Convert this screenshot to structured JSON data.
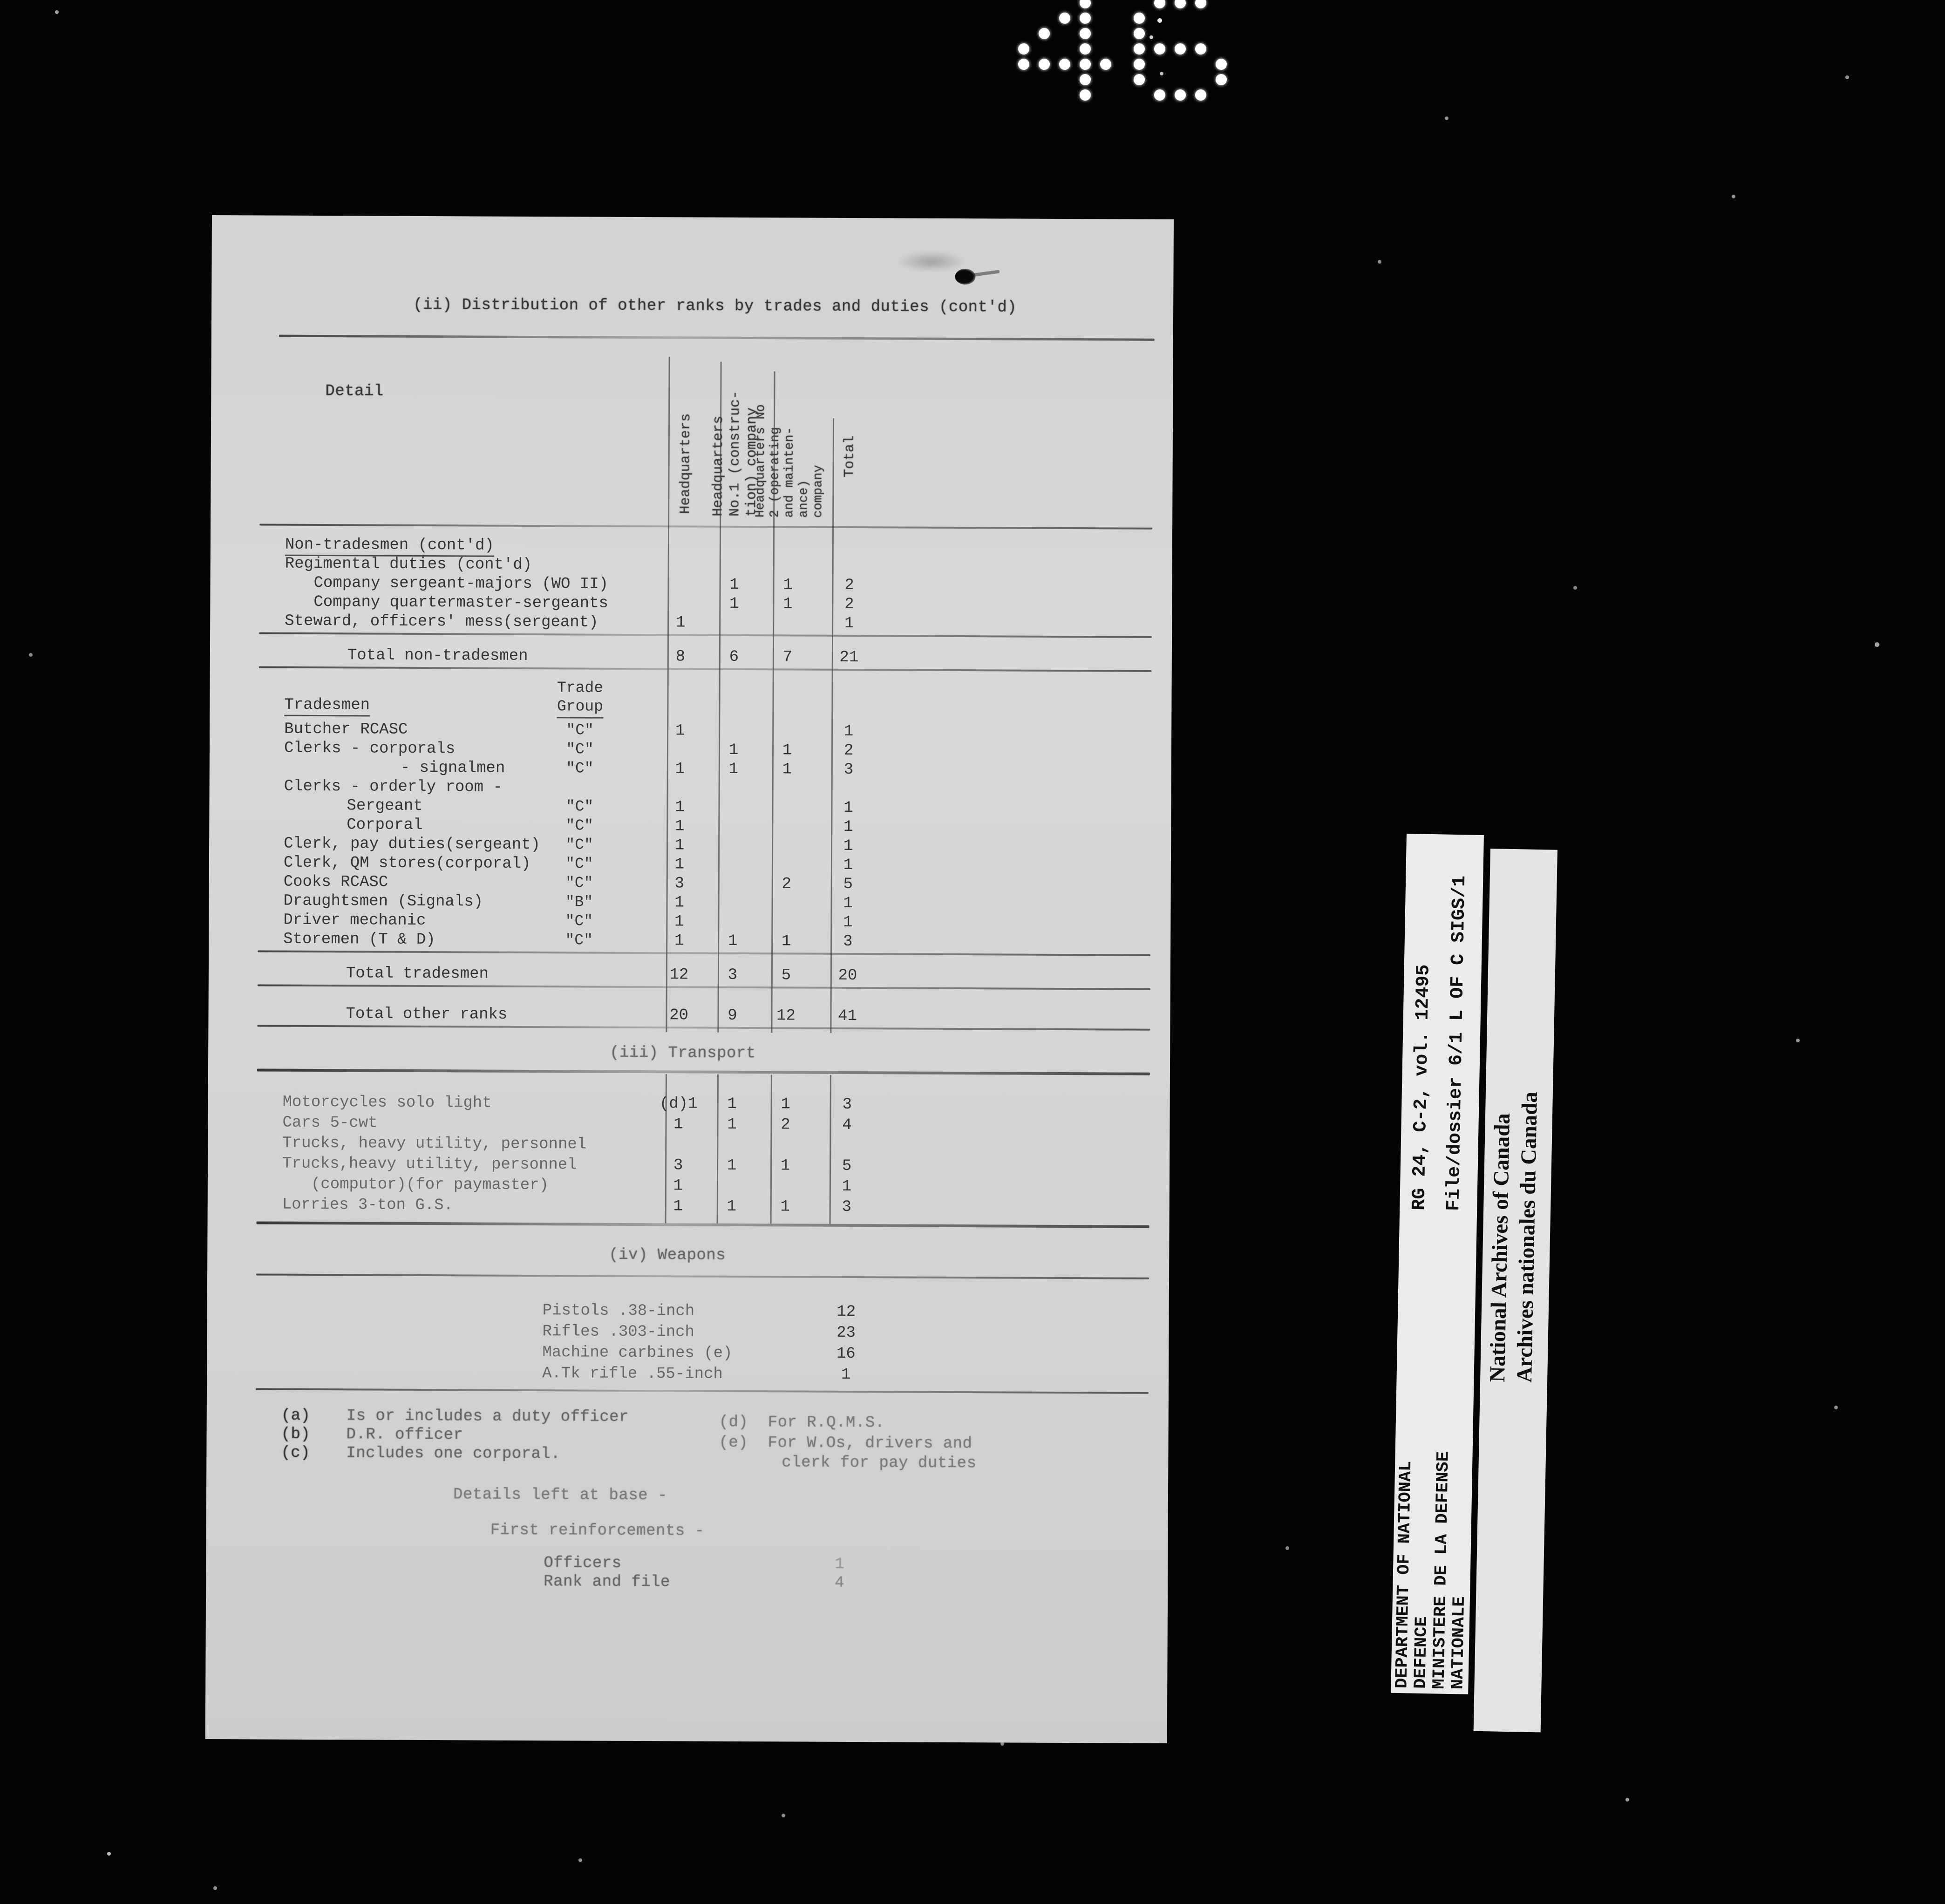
{
  "page_number": "46",
  "colors": {
    "background": "#040404",
    "paper": "#d5d5d5",
    "ink": "#363636",
    "label_paper": "#ebebeb"
  },
  "title": "(ii) Distribution of other ranks by trades and duties (cont'd)",
  "table": {
    "detail_header": "Detail",
    "column_headers": [
      [
        "Headquarters"
      ],
      [
        "Headquarters",
        "No.1 (construc-",
        "tion) company"
      ],
      [
        "Headquarters No",
        "2 (operating",
        "and mainten-",
        "ance)",
        "company"
      ],
      [
        "Total"
      ]
    ],
    "trade_group_header": [
      "Trade",
      "Group"
    ],
    "rows": [
      {
        "label": "Non-tradesmen (cont'd)",
        "indent": 0,
        "underline": true
      },
      {
        "label": "Regimental duties (cont'd)",
        "indent": 0
      },
      {
        "label": "Company sergeant-majors (WO II)",
        "indent": 1,
        "vals": [
          "",
          "1",
          "1",
          "2"
        ]
      },
      {
        "label": "Company quartermaster-sergeants",
        "indent": 1,
        "vals": [
          "",
          "1",
          "1",
          "2"
        ]
      },
      {
        "label": "Steward, officers' mess(sergeant)",
        "indent": 0,
        "vals": [
          "1",
          "",
          "",
          "1"
        ]
      },
      {
        "type": "rule"
      },
      {
        "type": "gap"
      },
      {
        "label": "Total non-tradesmen",
        "indent": 2,
        "vals": [
          "8",
          "6",
          "7",
          "21"
        ]
      },
      {
        "type": "rule"
      },
      {
        "type": "gap"
      },
      {
        "type": "tradesmen_header"
      },
      {
        "label": "Butcher RCASC",
        "indent": 0,
        "tg": "\"C\"",
        "vals": [
          "1",
          "",
          "",
          "1"
        ]
      },
      {
        "label": "Clerks - corporals",
        "indent": 0,
        "tg": "\"C\"",
        "vals": [
          "",
          "1",
          "1",
          "2"
        ]
      },
      {
        "label": "- signalmen",
        "indent": 3,
        "tg": "\"C\"",
        "vals": [
          "1",
          "1",
          "1",
          "3"
        ]
      },
      {
        "label": "Clerks - orderly room -",
        "indent": 0
      },
      {
        "label": "Sergeant",
        "indent": 2,
        "tg": "\"C\"",
        "vals": [
          "1",
          "",
          "",
          "1"
        ]
      },
      {
        "label": "Corporal",
        "indent": 2,
        "tg": "\"C\"",
        "vals": [
          "1",
          "",
          "",
          "1"
        ]
      },
      {
        "label": "Clerk, pay duties(sergeant)",
        "indent": 0,
        "tg": "\"C\"",
        "vals": [
          "1",
          "",
          "",
          "1"
        ]
      },
      {
        "label": "Clerk, QM stores(corporal)",
        "indent": 0,
        "tg": "\"C\"",
        "vals": [
          "1",
          "",
          "",
          "1"
        ]
      },
      {
        "label": "Cooks RCASC",
        "indent": 0,
        "tg": "\"C\"",
        "vals": [
          "3",
          "",
          "2",
          "5"
        ]
      },
      {
        "label": "Draughtsmen (Signals)",
        "indent": 0,
        "tg": "\"B\"",
        "vals": [
          "1",
          "",
          "",
          "1"
        ]
      },
      {
        "label": "Driver mechanic",
        "indent": 0,
        "tg": "\"C\"",
        "vals": [
          "1",
          "",
          "",
          "1"
        ]
      },
      {
        "label": "Storemen (T & D)",
        "indent": 0,
        "tg": "\"C\"",
        "vals": [
          "1",
          "1",
          "1",
          "3"
        ]
      },
      {
        "type": "rule"
      },
      {
        "type": "gap"
      },
      {
        "label": "Total tradesmen",
        "indent": 2,
        "vals": [
          "12",
          "3",
          "5",
          "20"
        ]
      },
      {
        "type": "rule"
      },
      {
        "type": "gap"
      },
      {
        "type": "gap"
      },
      {
        "label": "Total other ranks",
        "indent": 2,
        "vals": [
          "20",
          "9",
          "12",
          "41"
        ]
      },
      {
        "type": "rule"
      }
    ]
  },
  "transport": {
    "section_title": "(iii) Transport",
    "rows": [
      {
        "label": "Motorcycles solo light",
        "indent": 0,
        "vals": [
          "(d)1",
          "1",
          "1",
          "3"
        ]
      },
      {
        "label": "Cars 5-cwt",
        "indent": 0,
        "vals": [
          "1",
          "1",
          "2",
          "4"
        ]
      },
      {
        "label": "Trucks, heavy utility, personnel",
        "indent": 0,
        "vals": [
          "",
          "",
          "",
          ""
        ]
      },
      {
        "label": "Trucks,heavy utility, personnel",
        "indent": 0,
        "vals": [
          "3",
          "1",
          "1",
          "5"
        ]
      },
      {
        "label": "(computor)(for paymaster)",
        "indent": 1,
        "vals": [
          "1",
          "",
          "",
          "1"
        ]
      },
      {
        "label": "Lorries 3-ton G.S.",
        "indent": 0,
        "vals": [
          "1",
          "1",
          "1",
          "3"
        ]
      }
    ]
  },
  "weapons": {
    "section_title": "(iv) Weapons",
    "rows": [
      {
        "label": "Pistols .38-inch",
        "val": "12"
      },
      {
        "label": "Rifles .303-inch",
        "val": "23"
      },
      {
        "label": "Machine carbines (e)",
        "val": "16"
      },
      {
        "label": "A.Tk rifle .55-inch",
        "val": "1"
      }
    ]
  },
  "footnotes": {
    "left": [
      {
        "marker": "(a)",
        "text": "Is or includes a duty officer"
      },
      {
        "marker": "(b)",
        "text": "D.R. officer"
      },
      {
        "marker": "(c)",
        "text": "Includes one corporal."
      }
    ],
    "right": [
      {
        "marker": "(d)",
        "text": "For R.Q.M.S."
      },
      {
        "marker": "(e)",
        "text": "For W.Os, drivers and",
        "text2": "clerk for pay duties"
      }
    ]
  },
  "bottom": {
    "details_line": "Details left at base -",
    "reinforcements_line": "First reinforcements -",
    "items": [
      {
        "label": "Officers",
        "value": "1"
      },
      {
        "label": "Rank and file",
        "value": "4"
      }
    ]
  },
  "side_labels": {
    "department_lines": [
      "DEPARTMENT OF NATIONAL",
      "DEFENCE",
      "MINISTERE DE LA DEFENSE",
      "NATIONALE"
    ],
    "archival_ref_line1": "RG 24, C-2, vol. 12495",
    "archival_ref_line2": "File/dossier 6/1 L OF C SIGS/1",
    "archives_lines": [
      "National Archives of Canada",
      "Archives nationales du Canada"
    ]
  }
}
